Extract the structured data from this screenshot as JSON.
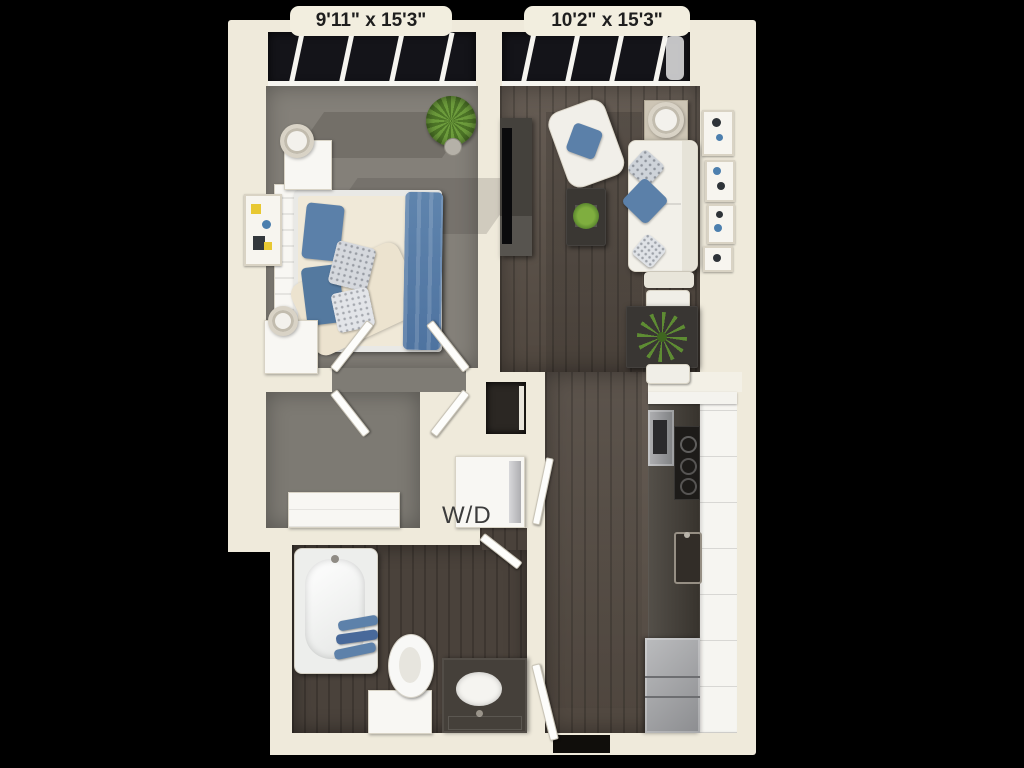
{
  "canvas": {
    "background": "#000000"
  },
  "floor_plan": {
    "view": "3d-top-down-apartment-floor-plan",
    "dimension_labels": [
      {
        "room": "bedroom",
        "text": "9'11\" x 15'3\""
      },
      {
        "room": "living-room",
        "text": "10'2\" x 15'3\""
      }
    ],
    "appliance_labels": [
      {
        "id": "washer-dryer",
        "text": "W/D"
      }
    ],
    "colors": {
      "background": "#000000",
      "wall_cream": "#efeadb",
      "carpet_gray": "#848079",
      "hardwood_dark": "#5a5047",
      "hardwood_bath": "#4a423b",
      "window_glass": "#141419",
      "accent_blue": "#5b80a9",
      "plant_green": "#6d9c3c",
      "counter_dark": "#413c35",
      "stainless_gray": "#a3a4a6",
      "furniture_white": "#f2f0e9",
      "label_text": "#1e1e1e"
    },
    "rooms": [
      {
        "id": "bedroom",
        "dimension_label": "9'11\" x 15'3\"",
        "floor": "carpet",
        "contents": [
          "bed",
          "headboard",
          "nightstand-with-lamp",
          "nightstand-with-lamp",
          "wall-art",
          "potted-plant",
          "double-doors",
          "floor-to-ceiling-windows"
        ]
      },
      {
        "id": "living-room",
        "dimension_label": "10'2\" x 15'3\"",
        "floor": "hardwood",
        "contents": [
          "sofa",
          "armchair",
          "coffee-table-with-plant",
          "side-table-with-lamp",
          "tv-console",
          "tv",
          "ottoman",
          "dining-table-with-palm",
          "dining-chair",
          "dining-chair",
          "wall-art-gallery",
          "floor-to-ceiling-windows"
        ]
      },
      {
        "id": "walk-in-closet",
        "floor": "carpet",
        "contents": [
          "dresser",
          "double-doors"
        ]
      },
      {
        "id": "laundry-closet",
        "label": "W/D",
        "contents": [
          "stacked-washer-dryer"
        ]
      },
      {
        "id": "pantry-nook",
        "contents": []
      },
      {
        "id": "bathroom",
        "floor": "hardwood",
        "contents": [
          "bathtub",
          "towels",
          "toilet",
          "vanity-with-sink",
          "door"
        ]
      },
      {
        "id": "kitchen",
        "floor": "hardwood",
        "contents": [
          "cabinet-run",
          "countertop",
          "wall-oven",
          "cooktop",
          "kitchen-sink",
          "refrigerator"
        ]
      },
      {
        "id": "entry",
        "contents": [
          "entry-door",
          "threshold"
        ]
      }
    ]
  }
}
